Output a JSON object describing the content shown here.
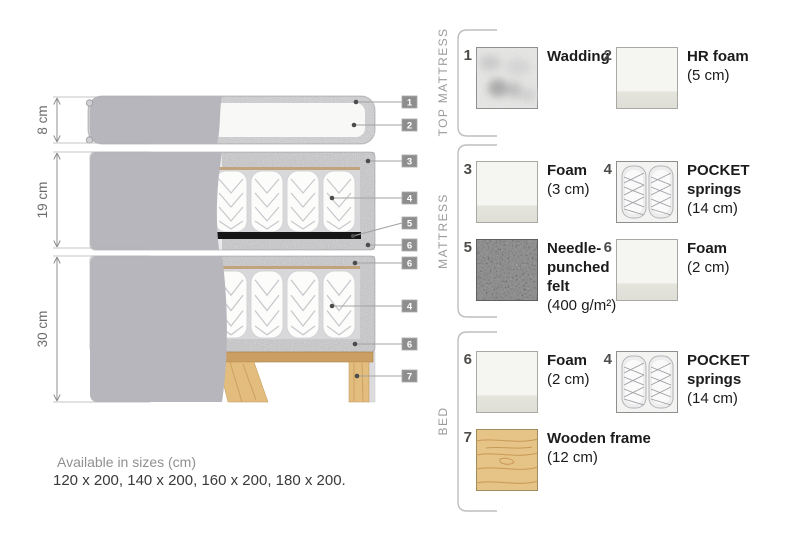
{
  "diagram": {
    "dimensions": [
      {
        "label": "8 cm"
      },
      {
        "label": "19 cm"
      },
      {
        "label": "30 cm"
      }
    ],
    "callouts": [
      "1",
      "2",
      "3",
      "4",
      "5",
      "6",
      "6",
      "4",
      "6",
      "7"
    ]
  },
  "legend": {
    "sections": [
      {
        "title": "TOP MATTRESS",
        "items": [
          {
            "num": "1",
            "name": "Wadding",
            "detail": "",
            "swatch": "wadding"
          },
          {
            "num": "2",
            "name": "HR foam",
            "detail": "(5 cm)",
            "swatch": "foam"
          }
        ]
      },
      {
        "title": "MATTRESS",
        "items": [
          {
            "num": "3",
            "name": "Foam",
            "detail": "(3 cm)",
            "swatch": "foam"
          },
          {
            "num": "4",
            "name": "POCKET springs",
            "detail": "(14 cm)",
            "swatch": "pocket-springs"
          },
          {
            "num": "5",
            "name": "Needle-punched felt",
            "detail": "(400 g/m²)",
            "swatch": "felt"
          },
          {
            "num": "6",
            "name": "Foam",
            "detail": "(2 cm)",
            "swatch": "foam"
          }
        ]
      },
      {
        "title": "BED",
        "items": [
          {
            "num": "6",
            "name": "Foam",
            "detail": "(2 cm)",
            "swatch": "foam"
          },
          {
            "num": "4",
            "name": "POCKET springs",
            "detail": "(14 cm)",
            "swatch": "pocket-springs"
          },
          {
            "num": "7",
            "name": "Wooden frame",
            "detail": "(12 cm)",
            "swatch": "wood"
          }
        ]
      }
    ]
  },
  "footer": {
    "line1": "Available in sizes (cm)",
    "line2": "120 x 200, 140 x 200, 160 x 200, 180 x 200."
  },
  "colors": {
    "fabric_gray": "#b6b6bc",
    "foam_speckle": "#eaeaec",
    "spring_white": "#fcfcfb",
    "felt_black": "#161616",
    "wood_tan": "#e3bd7e",
    "callout_gray": "#8e8e8e",
    "text_dark": "#1b1b1b",
    "text_muted": "#9b9b9b"
  }
}
